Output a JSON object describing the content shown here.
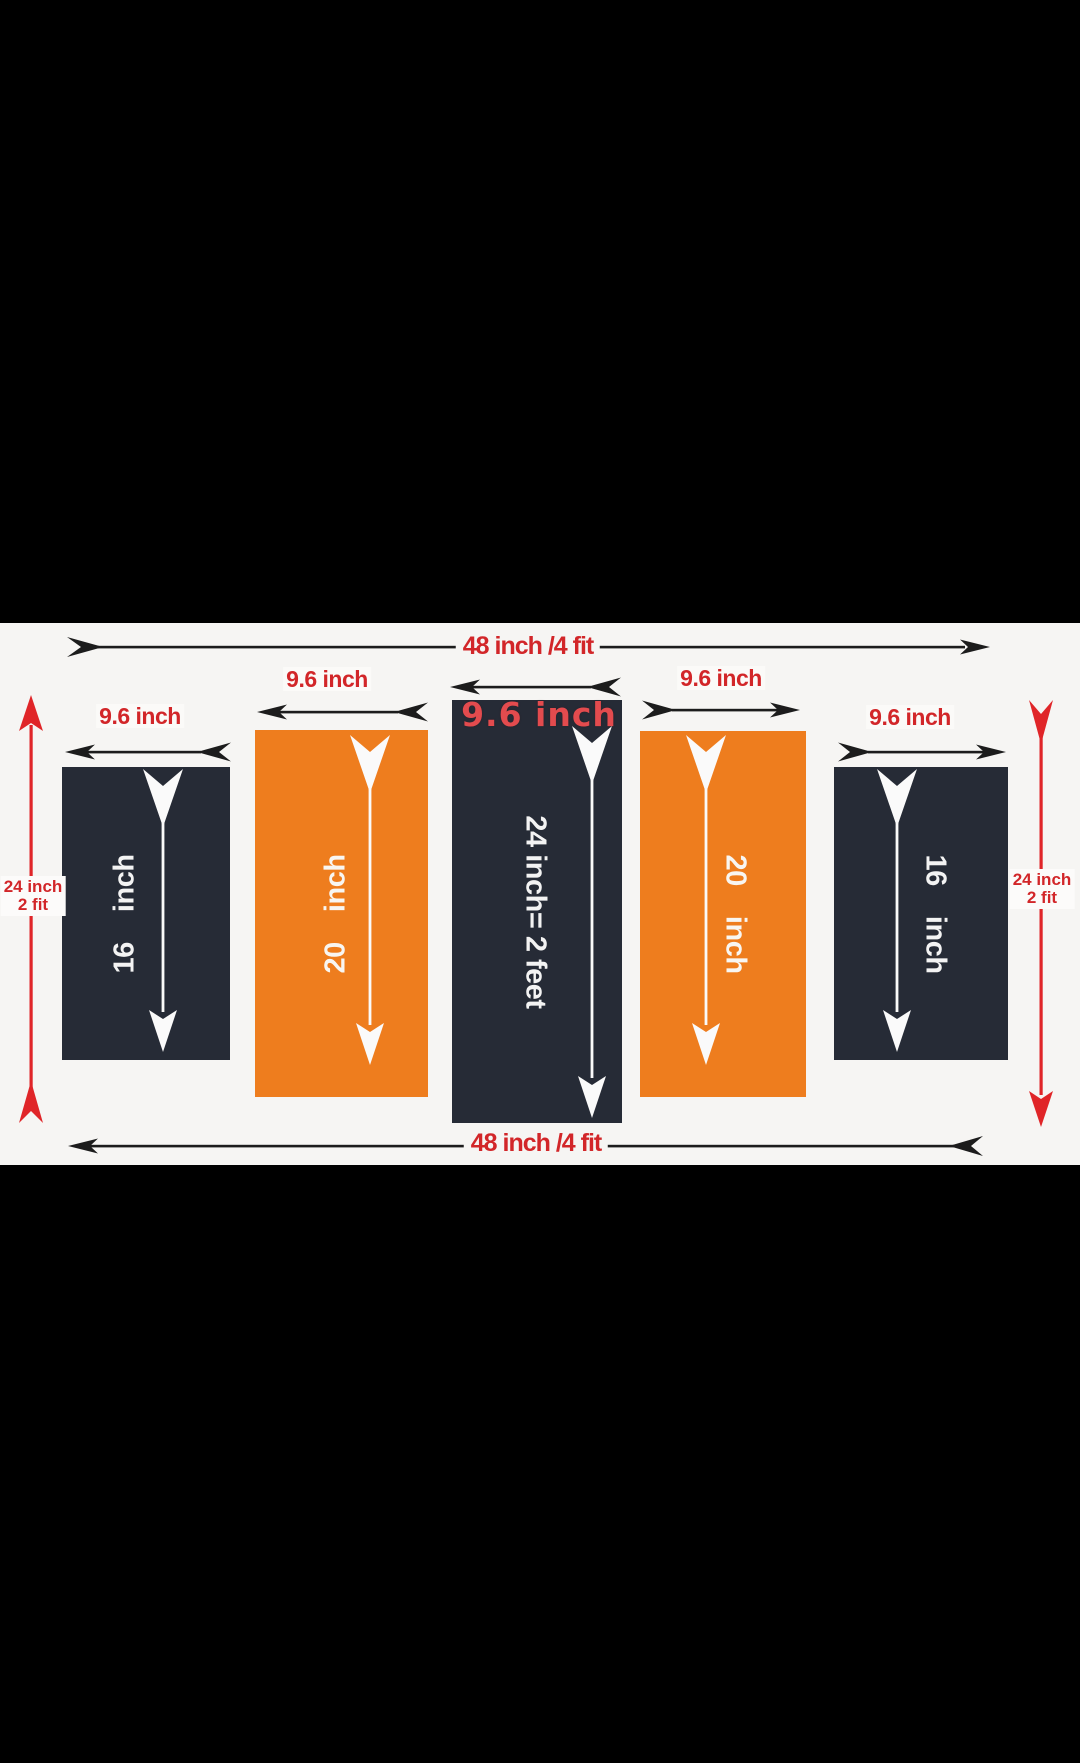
{
  "diagram": {
    "top_dimension": "48 inch /4 fit",
    "bottom_dimension": "48 inch /4 fit",
    "left_height": {
      "line1": "24 inch",
      "line2": "2 fit"
    },
    "right_height": {
      "line1": "24 inch",
      "line2": "2 fit"
    },
    "panels": [
      {
        "width_label": "9.6 inch",
        "height_label": "16    inch",
        "color": "#262b36"
      },
      {
        "width_label": "9.6 inch",
        "height_label": "20    inch",
        "color": "#ee7d1e"
      },
      {
        "width_label": "9.6 inch",
        "height_label": "24 inch= 2 feet",
        "color": "#262b36"
      },
      {
        "width_label": "9.6 inch",
        "height_label": "20    inch",
        "color": "#ee7d1e"
      },
      {
        "width_label": "9.6 inch",
        "height_label": "16    inch",
        "color": "#262b36"
      }
    ],
    "colors": {
      "letterbox": "#000000",
      "canvas": "#f6f5f3",
      "panel_dark": "#262b36",
      "panel_orange": "#ee7d1e",
      "dimension_red": "#d22629",
      "overlay_red": "#e34b4e",
      "arrow_black": "#1c1c1c",
      "arrow_red": "#e02528",
      "arrow_white": "#fafafa"
    }
  }
}
